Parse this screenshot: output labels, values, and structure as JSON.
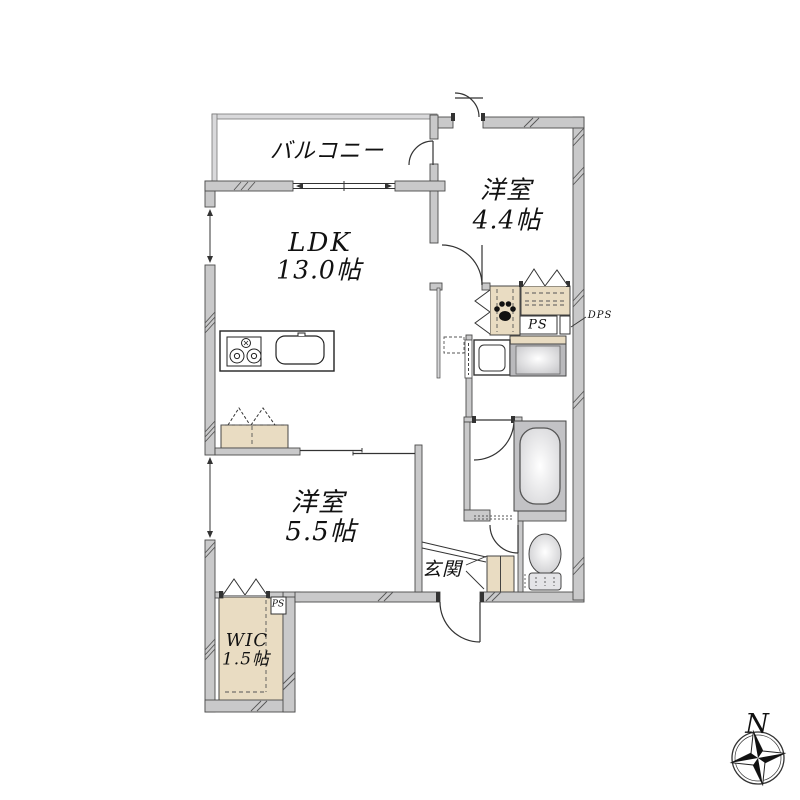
{
  "floor_plan": {
    "rooms": {
      "balcony": {
        "label": "バルコニー"
      },
      "ldk": {
        "label": "LDK",
        "size": "13.0帖"
      },
      "bedroom1": {
        "label": "洋室",
        "size": "4.4帖"
      },
      "bedroom2": {
        "label": "洋室",
        "size": "5.5帖"
      },
      "wic": {
        "label": "WIC",
        "size": "1.5帖"
      },
      "entrance": {
        "label": "玄関"
      }
    },
    "annotations": {
      "ps_label": "PS",
      "dps_label": "DPS",
      "wic_ps_label": "PS"
    },
    "compass": {
      "north": "N"
    },
    "colors": {
      "wall": "#c9c9ca",
      "closet_fill": "#e9dcc2",
      "line": "#333333",
      "fixture_gray": "#b9b9bc"
    }
  }
}
